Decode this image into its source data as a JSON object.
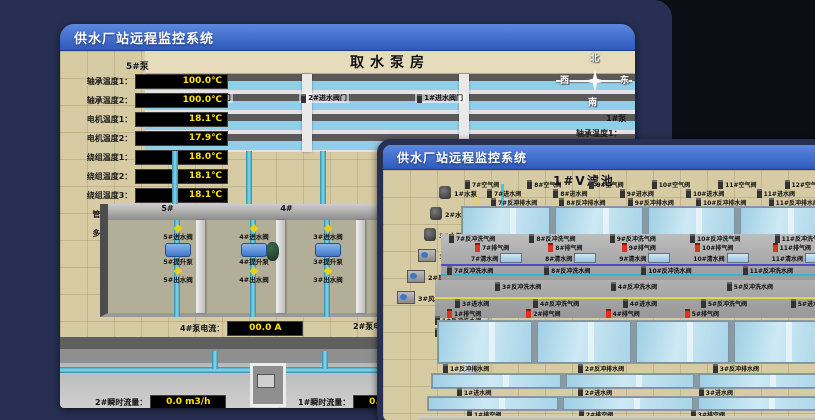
{
  "colors": {
    "titlebar_accent": "#3f6fd2",
    "desktop_navy": "#273053",
    "desktop_black": "#0b0e15",
    "value_text": "#ffe400",
    "alarm_red": "#e03020"
  },
  "back_window": {
    "title": "供水厂站远程监控系统",
    "scene_title": "取水泵房",
    "pump_panel": {
      "header": "5#泵",
      "rows": [
        {
          "label": "轴承温度1：",
          "value": "100.0℃"
        },
        {
          "label": "轴承温度2：",
          "value": "100.0℃"
        },
        {
          "label": "电机温度1：",
          "value": "18.1℃"
        },
        {
          "label": "电机温度2：",
          "value": "17.9℃"
        },
        {
          "label": "绕组温度1：",
          "value": "18.0℃"
        },
        {
          "label": "绕组温度2：",
          "value": "18.1℃"
        },
        {
          "label": "绕组温度3：",
          "value": "18.1℃"
        },
        {
          "label": "管道压力：",
          "value": "0.0007MPa"
        },
        {
          "label": "多功能阀：",
          "value": "0%"
        }
      ]
    },
    "right_panel": {
      "header": "1#泵",
      "rows": [
        "轴承温度1：",
        "轴承温度2："
      ]
    },
    "compass": {
      "north": "北",
      "south": "南",
      "west": "西",
      "east": "东"
    },
    "inlet_valve_doors": [
      "3#进水阀门",
      "2#进水阀门",
      "1#进水阀门"
    ],
    "bay_numbers": [
      "5#",
      "4#",
      "3#",
      "2#"
    ],
    "bays": [
      {
        "inlet": "5#进水阀",
        "pump": "5#提升泵",
        "outlet": "5#出水阀"
      },
      {
        "inlet": "4#进水阀",
        "pump": "4#提升泵",
        "outlet": "4#出水阀"
      },
      {
        "inlet": "3#进水阀",
        "pump": "3#提升泵",
        "outlet": "3#出水阀"
      }
    ],
    "current_readings": [
      {
        "label": "4#泵电流：",
        "value": "00.0 A"
      },
      {
        "label": "2#泵电流：",
        "value": ""
      }
    ],
    "flow_readings": [
      {
        "label": "2#瞬时流量：",
        "value": "0.0 m3/h"
      },
      {
        "label": "1#瞬时流量：",
        "value": "0.0 m3/h"
      }
    ]
  },
  "front_window": {
    "title": "供水厂站远程监控系统",
    "scene_title": "1#V滤池",
    "left_equipment": [
      "1#水泵",
      "2#水泵",
      "3#水泵",
      "1#风机",
      "2#风机",
      "3#风机"
    ],
    "air_valves_top": [
      "7#空气阀",
      "8#空气阀",
      "9#空气阀",
      "10#空气阀",
      "11#空气阀",
      "12#空气阀"
    ],
    "inlet_valves_top": [
      "7#进水阀",
      "8#进水阀",
      "9#进水阀",
      "10#进水阀",
      "11#进水阀"
    ],
    "drain_valves_top": [
      "7#反冲排水阀",
      "8#反冲排水阀",
      "9#反冲排水阀",
      "10#反冲排水阀",
      "11#反冲排水阀"
    ],
    "backwash_air_valves_upper": [
      "7#反冲洗气阀",
      "8#反冲洗气阀",
      "9#反冲洗气阀",
      "10#反冲洗气阀",
      "11#反冲洗气阀"
    ],
    "exhaust_valves_upper": [
      "7#排气阀",
      "8#排气阀",
      "9#排气阀",
      "10#排气阀",
      "11#排气阀"
    ],
    "clean_water_valves_upper": [
      "7#清水阀",
      "8#清水阀",
      "9#清水阀",
      "10#清水阀",
      "11#清水阀"
    ],
    "backwash_water_valves_upper": [
      "7#反冲洗水阀",
      "8#反冲洗水阀",
      "10#反冲洗水阀",
      "11#反冲洗水阀"
    ],
    "backwash_water_valves_mid": [
      "3#反冲洗水阀",
      "4#反冲洗水阀",
      "5#反冲洗水阀"
    ],
    "mixed_valves_mid": [
      "3#进水阀",
      "4#反冲洗气阀",
      "4#进水阀",
      "5#反冲洗气阀",
      "5#进水阀"
    ],
    "exhaust_valves_lower": [
      "1#排气阀",
      "2#排气阀",
      "4#排气阀",
      "5#排气阀"
    ],
    "left_edge_valves": [
      "1#反冲洗水阀",
      "1#反冲洗气阀"
    ],
    "drain_valves_bottom": [
      "1#反冲排水阀",
      "2#反冲排水阀",
      "3#反冲排水阀"
    ],
    "inlet_valves_bottom": [
      "1#进水阀",
      "2#进水阀",
      "3#进水阀"
    ],
    "vent_valves_bottom": [
      "1#排空阀",
      "2#排空阀",
      "3#排空阀"
    ]
  }
}
